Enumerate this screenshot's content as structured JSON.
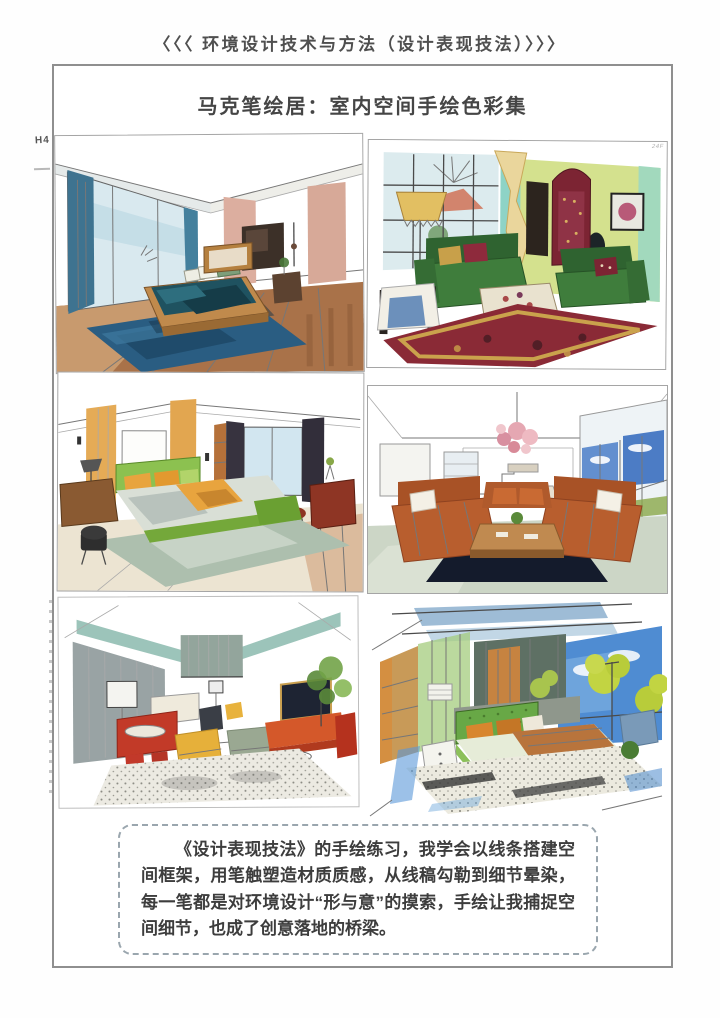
{
  "page": {
    "header": {
      "text": "〈〈〈 环境设计技术与方法（设计表现技法）〉〉〉"
    },
    "title": {
      "text": "马克笔绘居：室内空间手绘色彩集"
    },
    "caption": {
      "text": "《设计表现技法》的手绘练习，我学会以线条搭建空间框架，用笔触塑造材质质感，从线稿勾勒到细节晕染，每一笔都是对环境设计“形与意”的摸索，手绘让我捕捉空间细节，也成了创意落地的桥梁。"
    },
    "margin_notes": {
      "left_top": "H4",
      "panel2_corner": "24F"
    },
    "colors": {
      "border": "#8f8f8f",
      "caption_border": "#9aa6ae",
      "text": "#3d3d3d"
    }
  },
  "gallery": {
    "items": [
      {
        "id": "bedroom-blue",
        "description": "两点透视卧室手绘：蓝色窗帘、青蓝床品、蓝色地毯、粉色墙板、深木色地板",
        "palette": [
          "#3e7390",
          "#1f5260",
          "#2a5d82",
          "#a97249",
          "#dcae9f"
        ]
      },
      {
        "id": "vintage-living-room",
        "description": "复古客厅手绘：墨绿丝绒沙发、酒红展示柜、黄绿与青绿墙面、金色台灯、花纹地毯",
        "palette": [
          "#3f7d3c",
          "#7c2433",
          "#d4e18e",
          "#8ed3c6",
          "#ead69c"
        ]
      },
      {
        "id": "bedroom-green-orange",
        "description": "现代卧室手绘：草绿床具、橙黄抱枕、木饰面墙板、深色窗帘、红棕边柜",
        "palette": [
          "#8cc150",
          "#e8a43e",
          "#e5ab56",
          "#37333f",
          "#8e3524"
        ]
      },
      {
        "id": "living-room-one-point",
        "description": "一点透视客厅手绘：锈橙沙发对坐、粉色泡泡吊灯、深蓝地毯、蓝天大窗与远山",
        "palette": [
          "#b85e2e",
          "#e5a7b2",
          "#141b2c",
          "#4a7cc8",
          "#ccd6c6"
        ]
      },
      {
        "id": "lounge-sketch",
        "description": "线稿客厅手绘：青绿吊顶梁、灰色肌理墙、红色吧台与凳、黄色与灰绿坐墩、橙色电视柜、绿植",
        "palette": [
          "#9cc4ba",
          "#c23a28",
          "#e6b03a",
          "#d4582a",
          "#99a3a4"
        ]
      },
      {
        "id": "bedroom-axon",
        "description": "动态透视卧室手绘：绿色软包床、橙色枕头、蓝天绿树窗景、蓝灰顶棚板、木饰面",
        "palette": [
          "#68a846",
          "#d8862e",
          "#4f8cd2",
          "#c2d442",
          "#c89a58"
        ]
      }
    ]
  }
}
